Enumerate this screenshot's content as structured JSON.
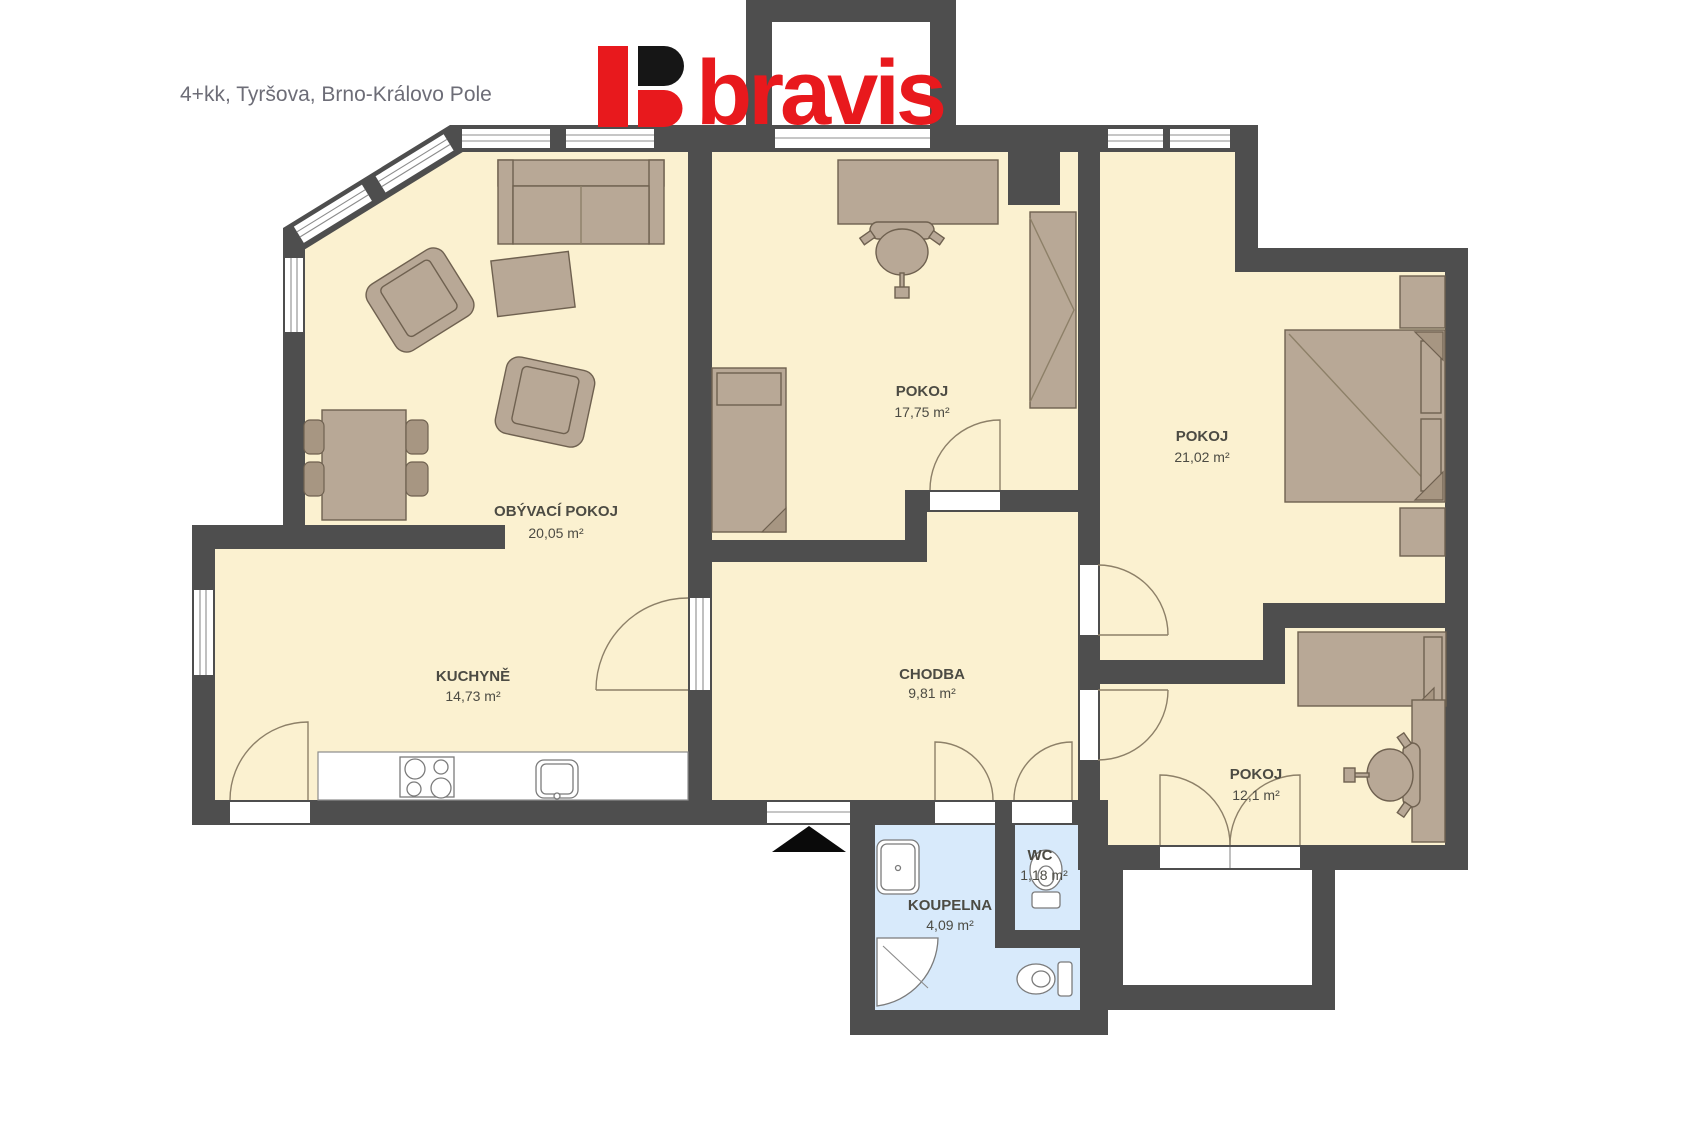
{
  "header": {
    "title": "4+kk, Tyršova, Brno-Královo Pole"
  },
  "logo": {
    "text": "bravis"
  },
  "rooms": [
    {
      "name": "OBÝVACÍ POKOJ",
      "area": "20,05 m²"
    },
    {
      "name": "POKOJ",
      "area": "17,75 m²"
    },
    {
      "name": "POKOJ",
      "area": "21,02 m²"
    },
    {
      "name": "KUCHYNĚ",
      "area": "14,73 m²"
    },
    {
      "name": "CHODBA",
      "area": "9,81 m²"
    },
    {
      "name": "POKOJ",
      "area": "12,1 m²"
    },
    {
      "name": "KOUPELNA",
      "area": "4,09 m²"
    },
    {
      "name": "WC",
      "area": "1,18 m²"
    }
  ],
  "colors": {
    "wall": "#4e4e4e",
    "floor": "#fbf1d0",
    "wet_floor": "#d8eafb",
    "furniture": "#b8a896",
    "furniture_outline": "#6f6150",
    "logo_red": "#e8191d",
    "logo_black": "#161616",
    "label": "#4c4b43",
    "title": "#6d6d77"
  }
}
